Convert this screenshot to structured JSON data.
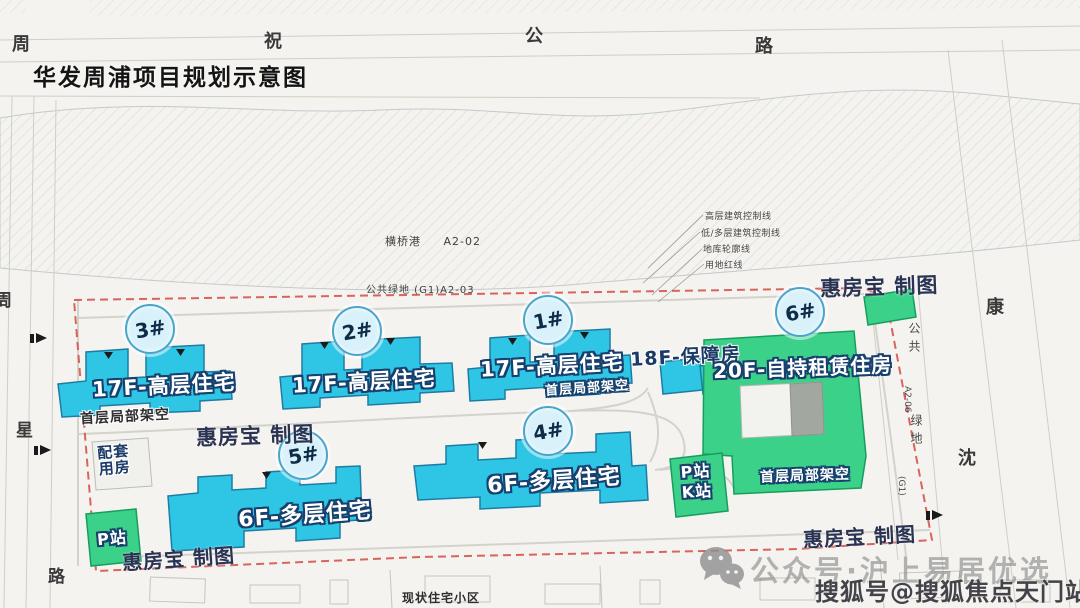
{
  "title": "华发周浦项目规划示意图",
  "roads": {
    "top": {
      "c1": "周",
      "c2": "祝",
      "c3": "公",
      "c4": "路"
    },
    "left": {
      "c1": "周",
      "c2": "星",
      "c3": "路"
    },
    "right": {
      "c1": "康",
      "c2": "沈"
    }
  },
  "parcels": {
    "canal_name": "横桥港",
    "canal_code": "A2-02",
    "green_top": "公共绿地 (G1)A2-03",
    "green_right_top": "公共",
    "green_right_code": "A2-06",
    "green_right_bottom": "绿地",
    "green_right_sub": "(G1)",
    "existing_area": "现状住宅小区"
  },
  "legend": {
    "line1": "高层建筑控制线",
    "line2": "低/多层建筑控制线",
    "line3": "地库轮廓线",
    "line4": "用地红线"
  },
  "buildings": {
    "b3": {
      "badge": "3#",
      "label": "17F-高层住宅",
      "note": "首层局部架空"
    },
    "b2": {
      "badge": "2#",
      "label": "17F-高层住宅"
    },
    "b1": {
      "badge": "1#",
      "label": "17F-高层住宅",
      "note": "首层局部架空"
    },
    "b18f": {
      "label": "18F-保障房"
    },
    "b6": {
      "badge": "6#",
      "label": "20F-自持租赁住房",
      "note": "首层局部架空"
    },
    "b5": {
      "badge": "5#",
      "label": "6F-多层住宅"
    },
    "b4": {
      "badge": "4#",
      "label": "6F-多层住宅"
    },
    "support": {
      "line1": "配套",
      "line2": "用房"
    },
    "p_station": {
      "label": "P站"
    },
    "pk_station": {
      "line1": "P站",
      "line2": "K站"
    }
  },
  "watermarks": {
    "brand": "惠房宝 制图",
    "wechat_account": "公众号·沪上易居优选",
    "sohu_account": "搜狐号@搜狐焦点天门站"
  },
  "colors": {
    "residential_cyan": "#2fc6e6",
    "rental_green": "#3bd189",
    "boundary_red": "#d5544b",
    "label_navy": "#17406e"
  }
}
